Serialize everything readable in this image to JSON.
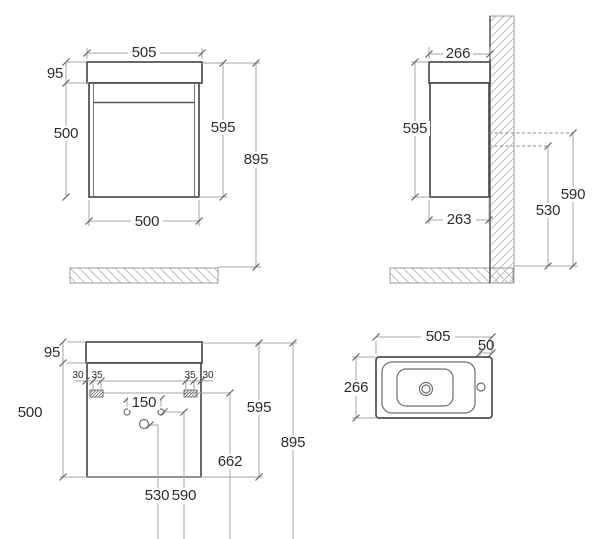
{
  "views": {
    "front": {
      "dims": {
        "width_top": "505",
        "basin_height": "95",
        "cabinet_height": "500",
        "unit_height": "595",
        "floor_height": "895",
        "width_bottom": "500"
      }
    },
    "side": {
      "dims": {
        "depth_top": "266",
        "unit_height": "595",
        "depth_bottom": "263",
        "fix_low": "530",
        "fix_high": "590"
      }
    },
    "fixing": {
      "dims": {
        "basin_height": "95",
        "cabinet_height": "500",
        "off_left": "30",
        "bracket_left": "35",
        "bracket_right": "35",
        "off_right": "30",
        "tap_spacing": "150",
        "unit_height": "595",
        "drain_height": "662",
        "floor_height": "895",
        "fix_low": "530",
        "fix_high": "590"
      }
    },
    "top": {
      "dims": {
        "width": "505",
        "tap_offset": "50",
        "depth": "266"
      }
    }
  }
}
